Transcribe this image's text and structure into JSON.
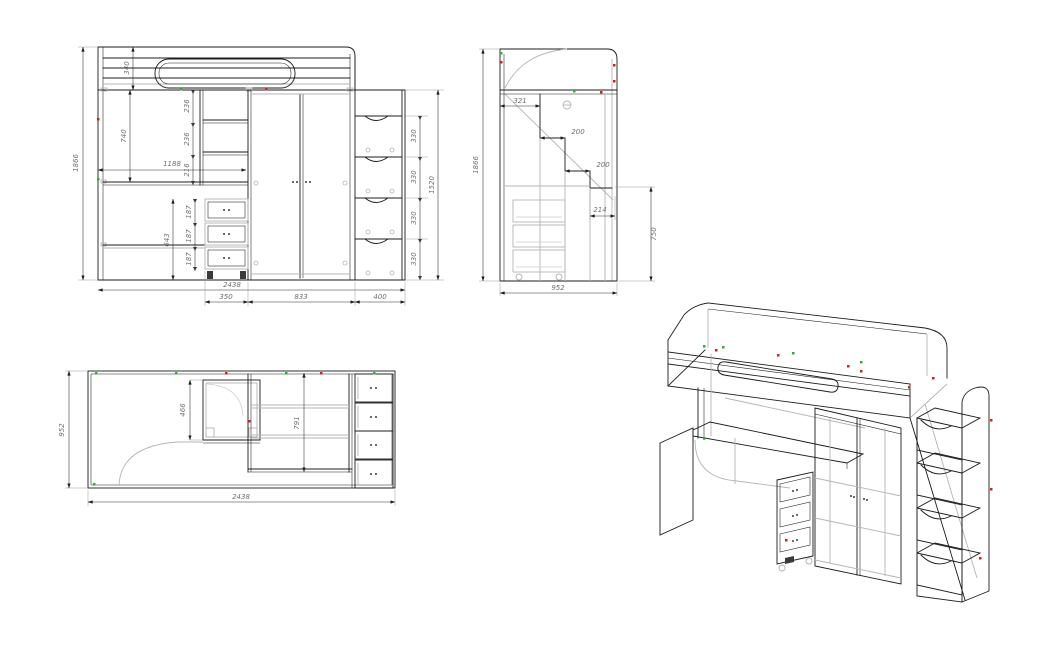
{
  "document": {
    "type": "furniture-assembly-drawing",
    "background": "#ffffff"
  },
  "colors": {
    "primary_line": "#1c1c1c",
    "secondary_line": "#b4b4b4",
    "dimension_text": "#6f6f6f",
    "marker_green": "#2fae2f",
    "marker_red": "#cc2222"
  },
  "views": {
    "front": {
      "label": "front-elevation",
      "dims": {
        "total_height": "1866",
        "bed_box_height": "340",
        "under_bed_clearance": "740",
        "desk_span": "1188",
        "shelf_gaps": [
          "236",
          "236",
          "216"
        ],
        "drawer_stack_height": "643",
        "drawer_heights": [
          "187",
          "187",
          "187"
        ],
        "total_width": "2438",
        "drawer_unit_width": "350",
        "wardrobe_width": "833",
        "ladder_width": "400",
        "ladder_height": "1520",
        "step_heights": [
          "330",
          "330",
          "330",
          "330"
        ]
      }
    },
    "side": {
      "label": "side-elevation",
      "dims": {
        "total_height": "1866",
        "depth": "952",
        "top_landing": "321",
        "step_run_1": "200",
        "step_run_2": "200",
        "step_run_3": "214",
        "desk_height": "750"
      }
    },
    "plan": {
      "label": "plan-view",
      "dims": {
        "depth": "952",
        "total_width": "2438",
        "cabinet_depth": "466",
        "wardrobe_depth": "791"
      }
    },
    "iso": {
      "label": "isometric-view"
    }
  }
}
